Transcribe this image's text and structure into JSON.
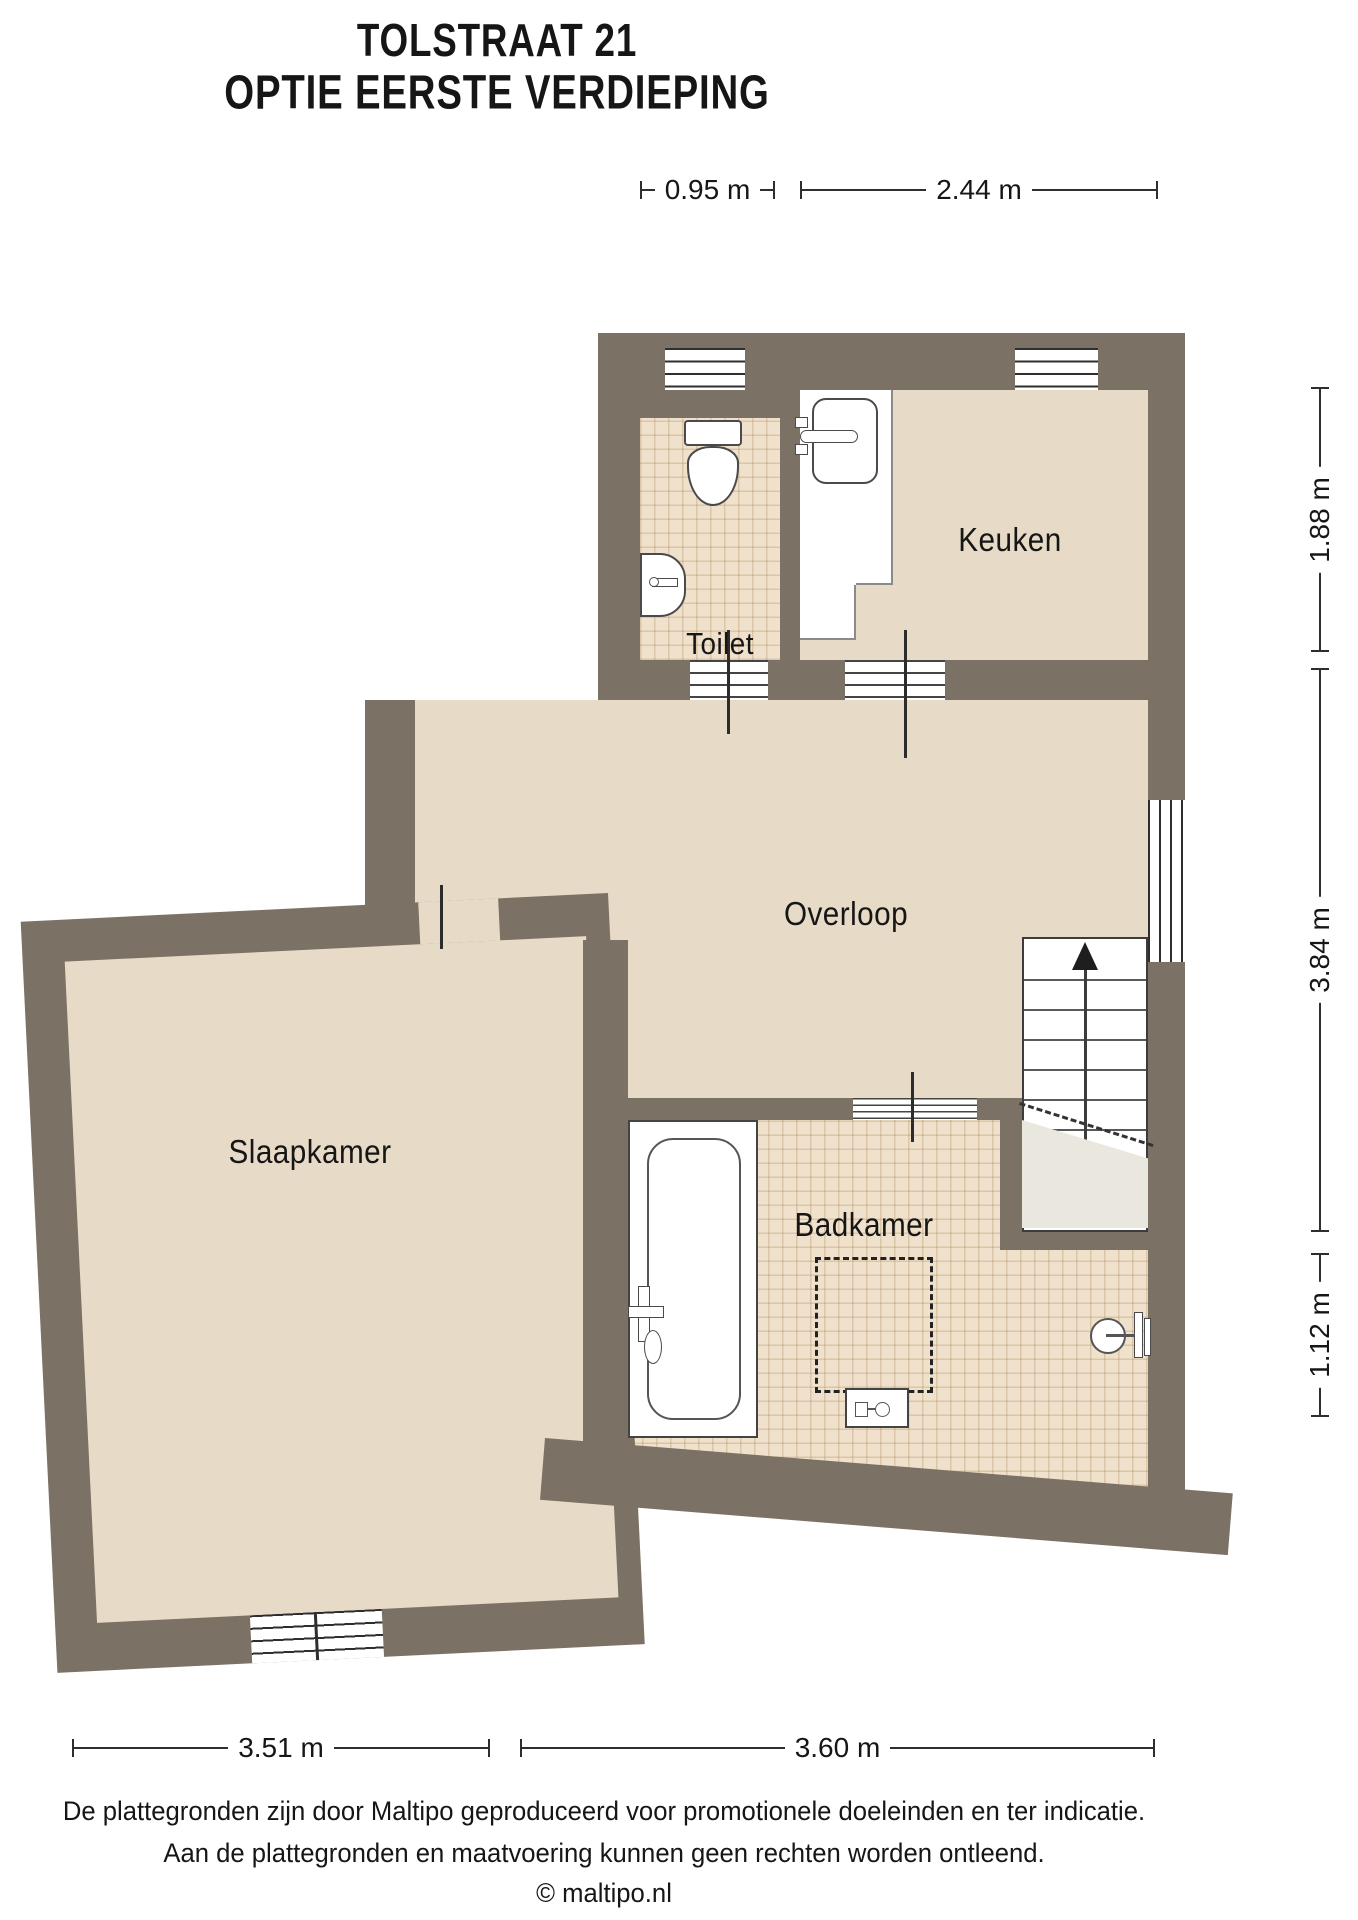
{
  "title": {
    "line1": "TOLSTRAAT 21",
    "line2": "OPTIE EERSTE VERDIEPING"
  },
  "rooms": {
    "kitchen": "Keuken",
    "toilet": "Toilet",
    "landing": "Overloop",
    "bedroom": "Slaapkamer",
    "bathroom": "Badkamer"
  },
  "dimensions": {
    "top_left": "0.95 m",
    "top_right": "2.44 m",
    "right_top": "1.88 m",
    "right_middle": "3.84 m",
    "right_bottom": "1.12 m",
    "bottom_left": "3.51 m",
    "bottom_right": "3.60 m"
  },
  "footer": {
    "line1": "De plattegronden zijn door Maltipo geproduceerd voor promotionele doeleinden en ter indicatie.",
    "line2": "Aan de plattegronden en maatvoering kunnen geen rechten worden ontleend.",
    "line3": "© maltipo.nl"
  },
  "colors": {
    "wall": "#7b7164",
    "floor": "#e7dac6",
    "tile": "#efe1cb",
    "closet": "#e9e7de"
  }
}
